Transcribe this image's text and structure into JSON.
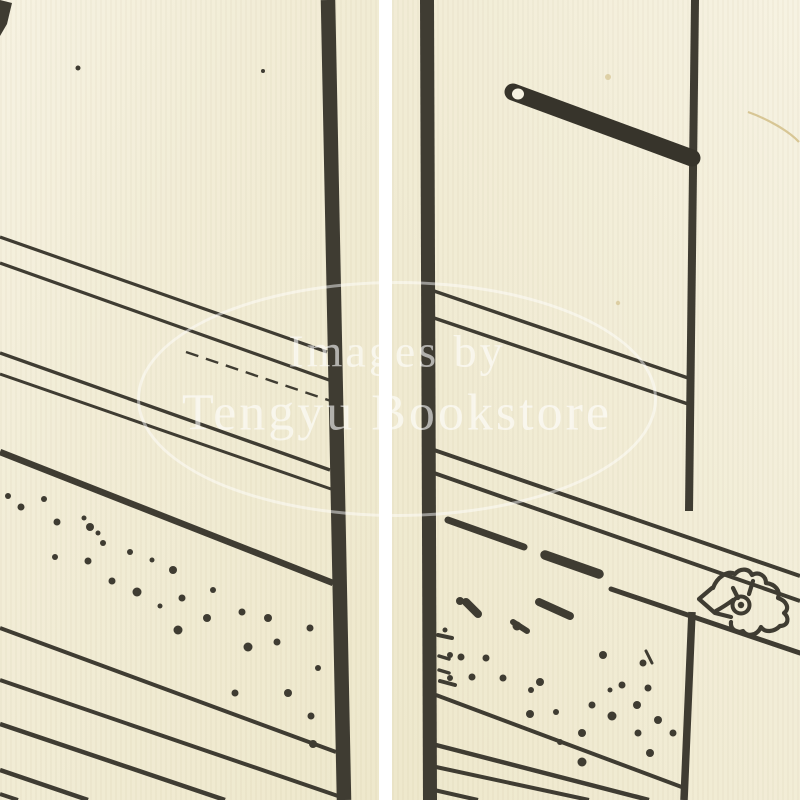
{
  "image": {
    "description": "Scanned close-up of a Japanese woodblock-printed book page, shown as two cream paper panels separated by a white gutter, with black ink linework: vertical rules, diagonal hatching lines, stippled dot bands, a latched rod, and a small flower crest",
    "panel_count": "2"
  },
  "watermark": {
    "line1": "Images by",
    "line2": "Tengyu Bookstore"
  },
  "colors": {
    "paper": "#f2edd7",
    "paper-light": "#f6f2e2",
    "paper-dark": "#eee8cc",
    "ink": "#3f3c32",
    "ink-dark": "#37342b",
    "gutter": "#ffffff",
    "watermark": "rgba(255,255,255,0.60)",
    "watermark-line": "rgba(255,255,255,0.48)",
    "stain": "#cdb87c"
  }
}
